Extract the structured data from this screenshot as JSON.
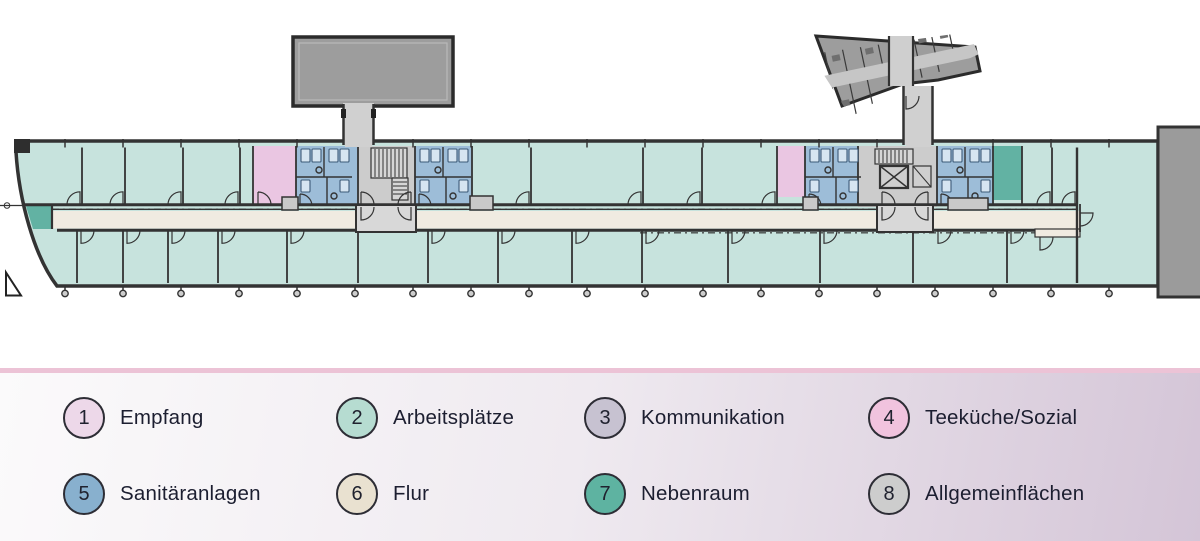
{
  "legend": {
    "items": [
      {
        "number": "1",
        "label": "Empfang",
        "color": "#edd8e9"
      },
      {
        "number": "2",
        "label": "Arbeitsplätze",
        "color": "#b6dcd1"
      },
      {
        "number": "3",
        "label": "Kommunikation",
        "color": "#c7c2d1"
      },
      {
        "number": "4",
        "label": "Teeküche/Sozial",
        "color": "#f1c3de"
      },
      {
        "number": "5",
        "label": "Sanitäranlagen",
        "color": "#88b0ce"
      },
      {
        "number": "6",
        "label": "Flur",
        "color": "#e9e1d0"
      },
      {
        "number": "7",
        "label": "Nebenraum",
        "color": "#5eb3a1"
      },
      {
        "number": "8",
        "label": "Allgemeinflächen",
        "color": "#cdcdcd"
      }
    ]
  },
  "plan": {
    "colors": {
      "wall": "#333333",
      "mint": "#c7e3dd",
      "teal": "#62b2a3",
      "pink": "#eac6e2",
      "blue": "#9dbdd8",
      "fixture": "#d6e5f1",
      "cream": "#f0ebe1",
      "core": "#cccccc",
      "stair": "#d6d6d6",
      "vest": "#d8d8d8",
      "wing": "#9d9d9d",
      "wingCorr": "#c6c6c6",
      "connector": "#d0d0d0",
      "block": "#9b9b9b",
      "cabinet": "#c9c9c9",
      "dot": "#cdcdcd",
      "legendLine": "#ecc3d6"
    }
  }
}
